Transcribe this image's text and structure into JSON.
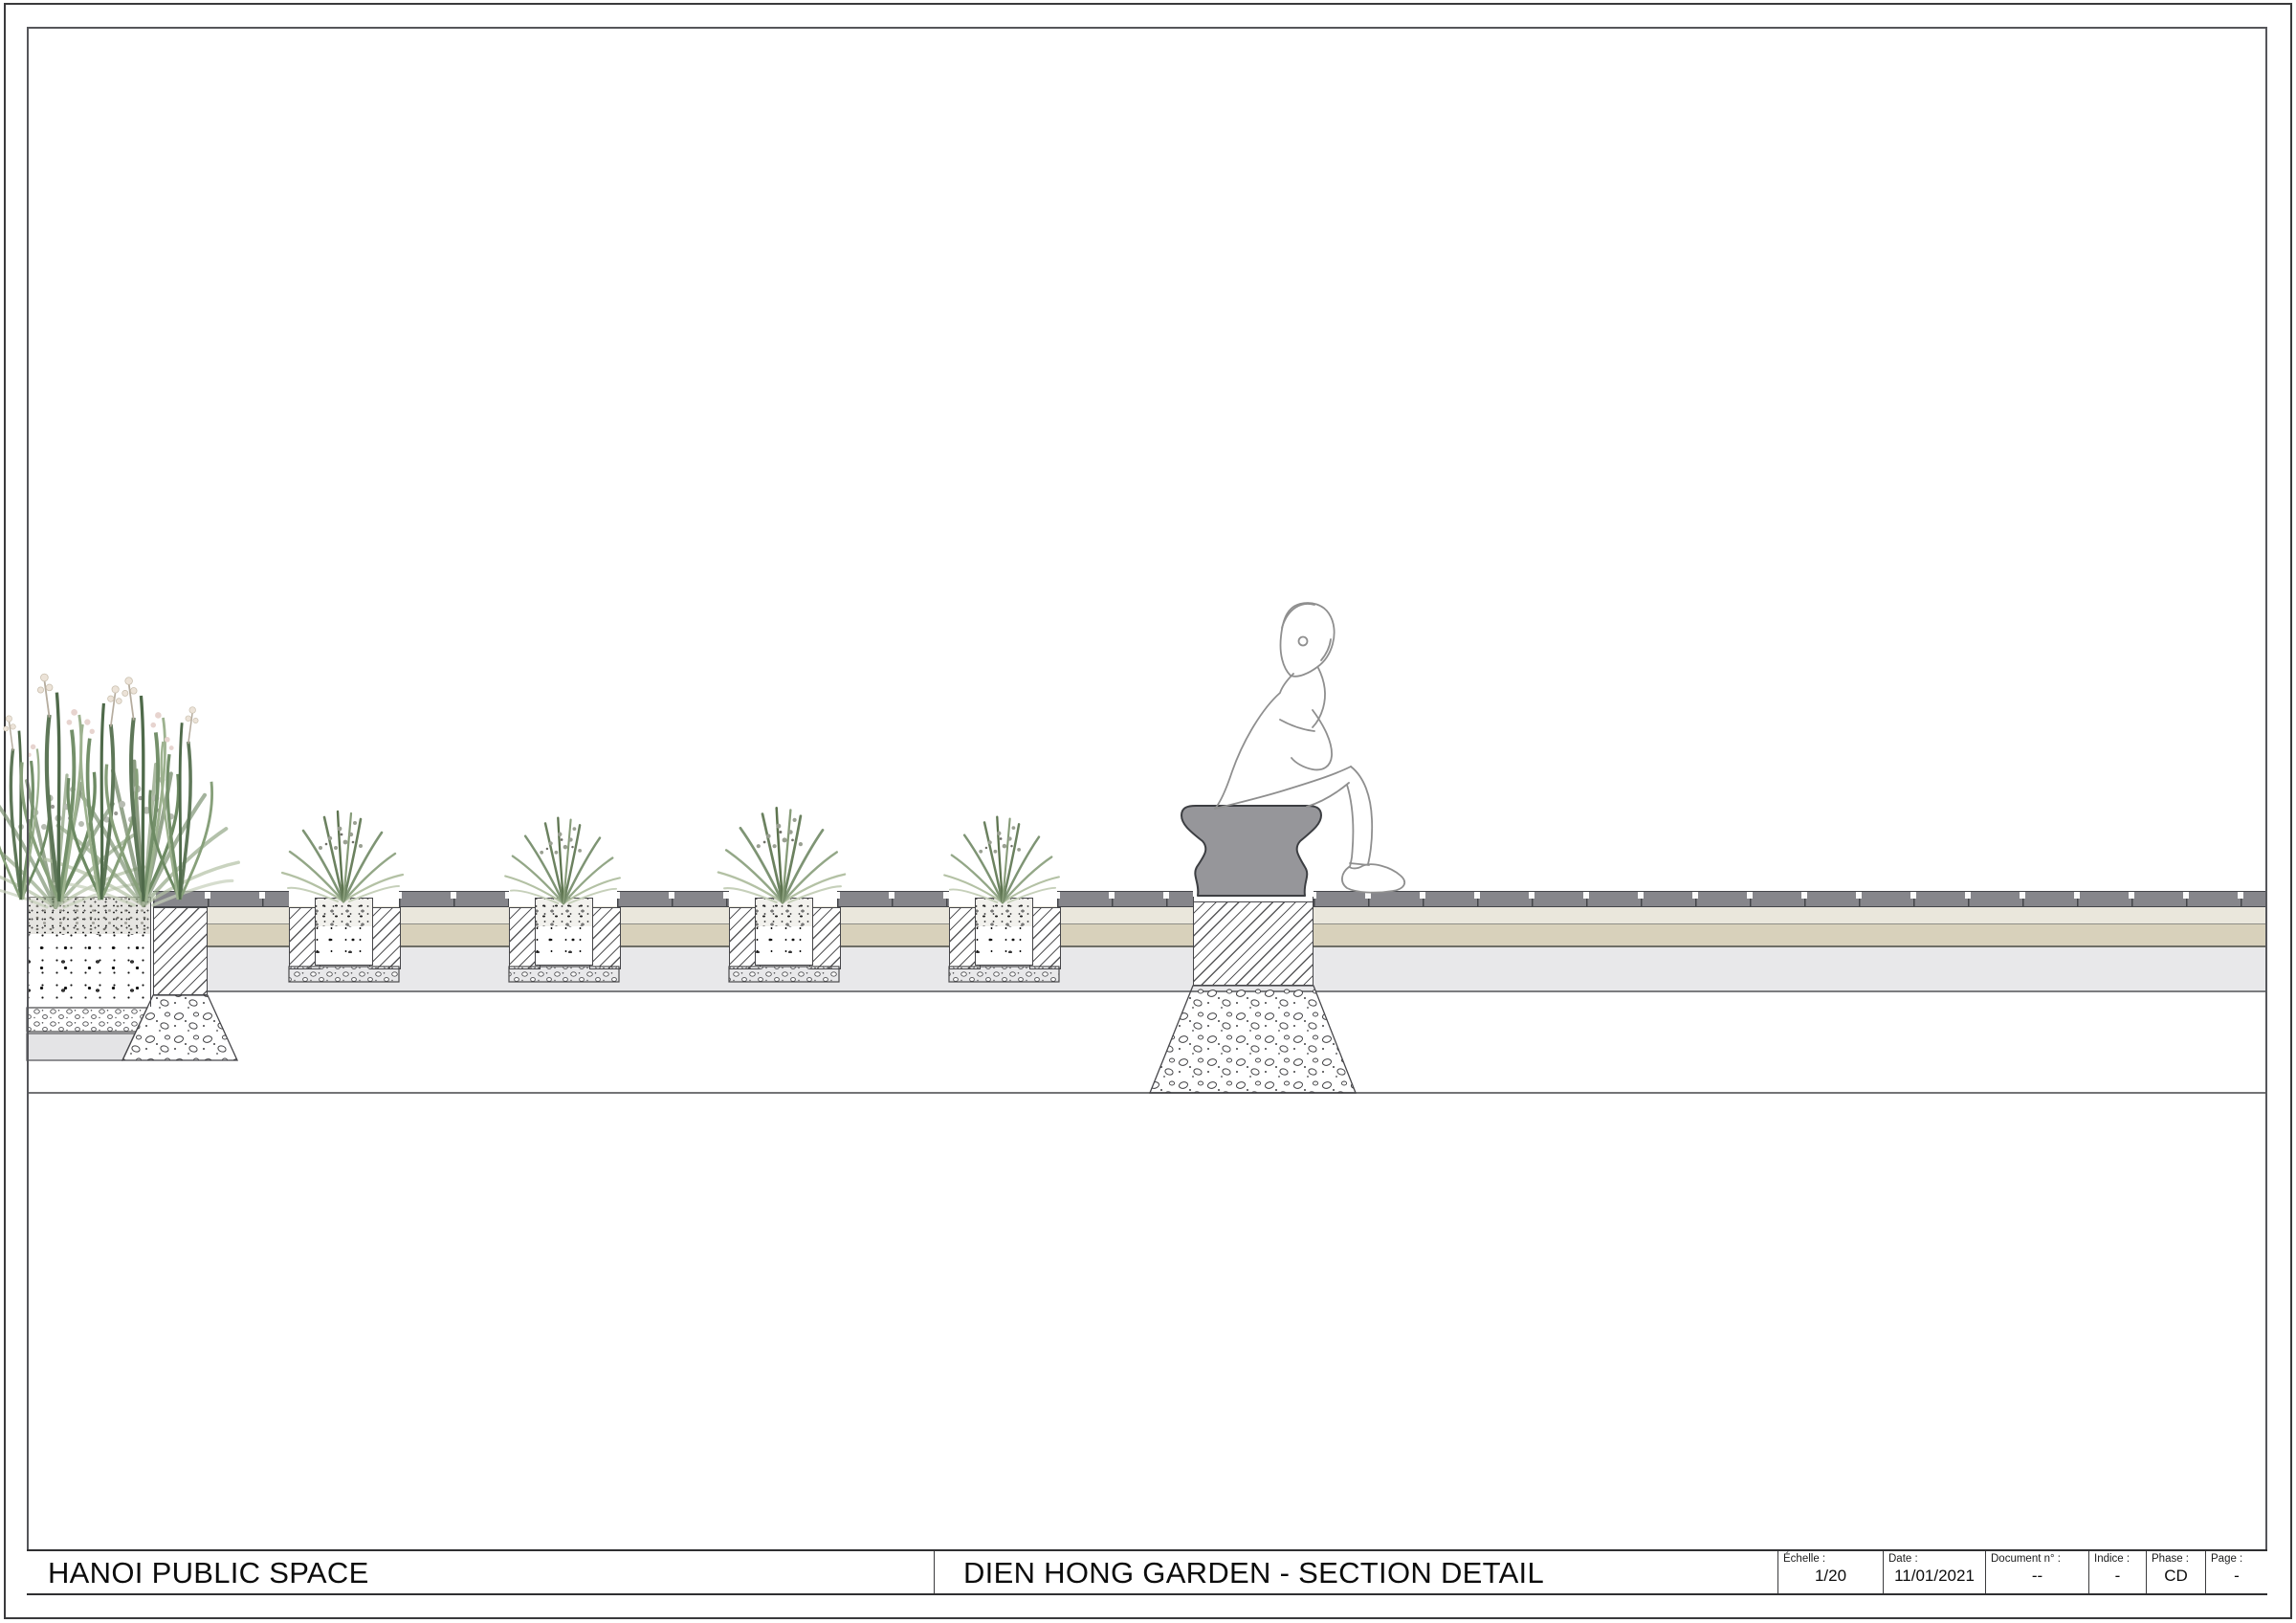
{
  "title_block": {
    "project": "HANOI PUBLIC SPACE",
    "drawing_title": "DIEN HONG GARDEN - SECTION DETAIL",
    "fields": [
      {
        "label": "Échelle :",
        "value": "1/20"
      },
      {
        "label": "Date :",
        "value": "11/01/2021"
      },
      {
        "label": "Document n° :",
        "value": "--"
      },
      {
        "label": "Indice :",
        "value": "-"
      },
      {
        "label": "Phase :",
        "value": "CD"
      },
      {
        "label": "Page :",
        "value": "-"
      }
    ]
  },
  "colors": {
    "paver_gray": "#86868b",
    "bedding_cream": "#eae7dc",
    "base_tan": "#d8d1bb",
    "subbase_gray": "#e8e8ea",
    "stool_gray": "#96969a",
    "outline_dark": "#46464a",
    "plant_green": "#7e9474"
  }
}
